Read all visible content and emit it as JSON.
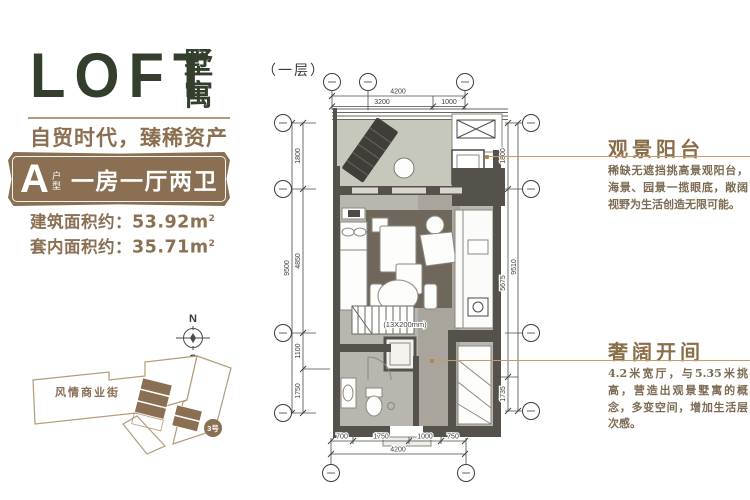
{
  "logo": {
    "text": "LOFT",
    "suffix": "墅寓"
  },
  "tagline": "自贸时代，臻稀资产",
  "unit_badge": {
    "letter": "A",
    "small_label": "户型",
    "title": "一房一厅两卫"
  },
  "areas": [
    {
      "label": "建筑面积约：",
      "value": "53.92",
      "unit": "m",
      "sup": "2"
    },
    {
      "label": "套内面积约：",
      "value": "35.71",
      "unit": "m",
      "sup": "2"
    }
  ],
  "compass": {
    "north": "N",
    "south": "S"
  },
  "site_map": {
    "street_label": "风情商业街",
    "building_label": "3号"
  },
  "floor_plan": {
    "level_label": "（一层）",
    "stair_note": "(13X200mm)",
    "dimensions": {
      "top": {
        "total": "4200",
        "segments": [
          "3200",
          "1000"
        ]
      },
      "bottom": {
        "total": "4200",
        "segments": [
          "700",
          "1750",
          "1000",
          "750"
        ]
      },
      "left": {
        "total": "9500",
        "segments": [
          "1800",
          "4850",
          "1100",
          "1750"
        ]
      },
      "right": {
        "total": "9510",
        "segments": [
          "1800",
          "5675",
          "1735"
        ]
      }
    }
  },
  "callouts": [
    {
      "title": "观景阳台",
      "body": "稀缺无遮挡挑高景观阳台，海景、园景一揽眼底，敞阔视野为生活创造无限可能。"
    },
    {
      "title": "奢阔开间",
      "body": "4.2米宽厅，与5.35米挑高，营造出观景墅寓的概念，多变空间，增加生活层次感。"
    }
  ],
  "colors": {
    "brand_green": "#333f2c",
    "brand_brown": "#8a6f52",
    "line_tan": "#b49a78",
    "leader_tan": "#c99a63",
    "wall_gray": "#55514b",
    "balcony_floor": "#c6c8bb",
    "room_floor": "#b8b6ae",
    "rug": "#6f675c"
  }
}
